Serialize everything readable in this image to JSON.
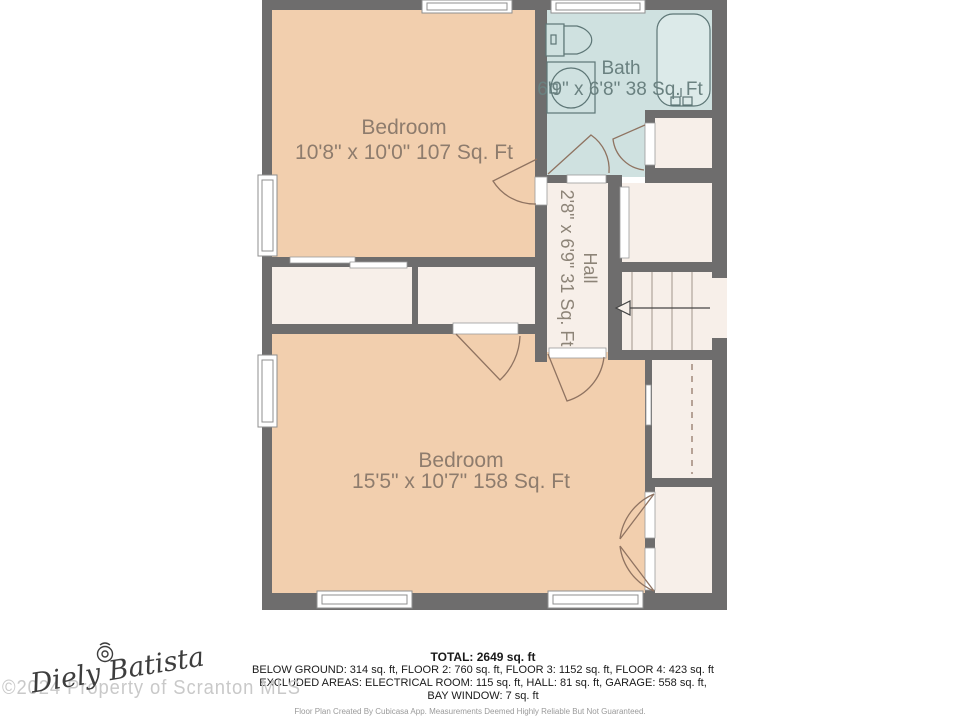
{
  "floor_plan": {
    "rooms": [
      {
        "id": "bedroom-top",
        "label": "Bedroom",
        "dims": "10'8\" x 10'0\" 107 Sq. Ft"
      },
      {
        "id": "bath",
        "label": "Bath",
        "dims": "6'9\" x 6'8\" 38 Sq. Ft"
      },
      {
        "id": "hall",
        "label": "Hall",
        "dims": "2'8\" x 6'9\" 31 Sq. Ft"
      },
      {
        "id": "bedroom-bottom",
        "label": "Bedroom",
        "dims": "15'5\" x 10'7\" 158 Sq. Ft"
      }
    ],
    "colors": {
      "wall": "#6e6d6d",
      "bedroom_floor": "#f2cfae",
      "bath_floor": "#cfe1e0",
      "hall_floor": "#f7efe9",
      "door_arc": "#8f7361",
      "fixture_stroke": "#5d7676"
    }
  },
  "summary": {
    "total": "TOTAL: 2649 sq. ft",
    "floors_line": "BELOW GROUND: 314 sq. ft, FLOOR 2: 760 sq. ft, FLOOR 3: 1152 sq. ft, FLOOR 4: 423 sq. ft",
    "excluded_line1": "EXCLUDED AREAS: ELECTRICAL ROOM: 115 sq. ft, HALL: 81 sq. ft, GARAGE: 558 sq. ft,",
    "excluded_line2": "BAY WINDOW: 7 sq. ft",
    "disclaimer": "Floor Plan Created By Cubicasa App. Measurements Deemed Highly Reliable But Not Guaranteed."
  },
  "watermark": {
    "signature": "Diely Batista",
    "copyright": "©2024 Property of Scranton MLS"
  }
}
